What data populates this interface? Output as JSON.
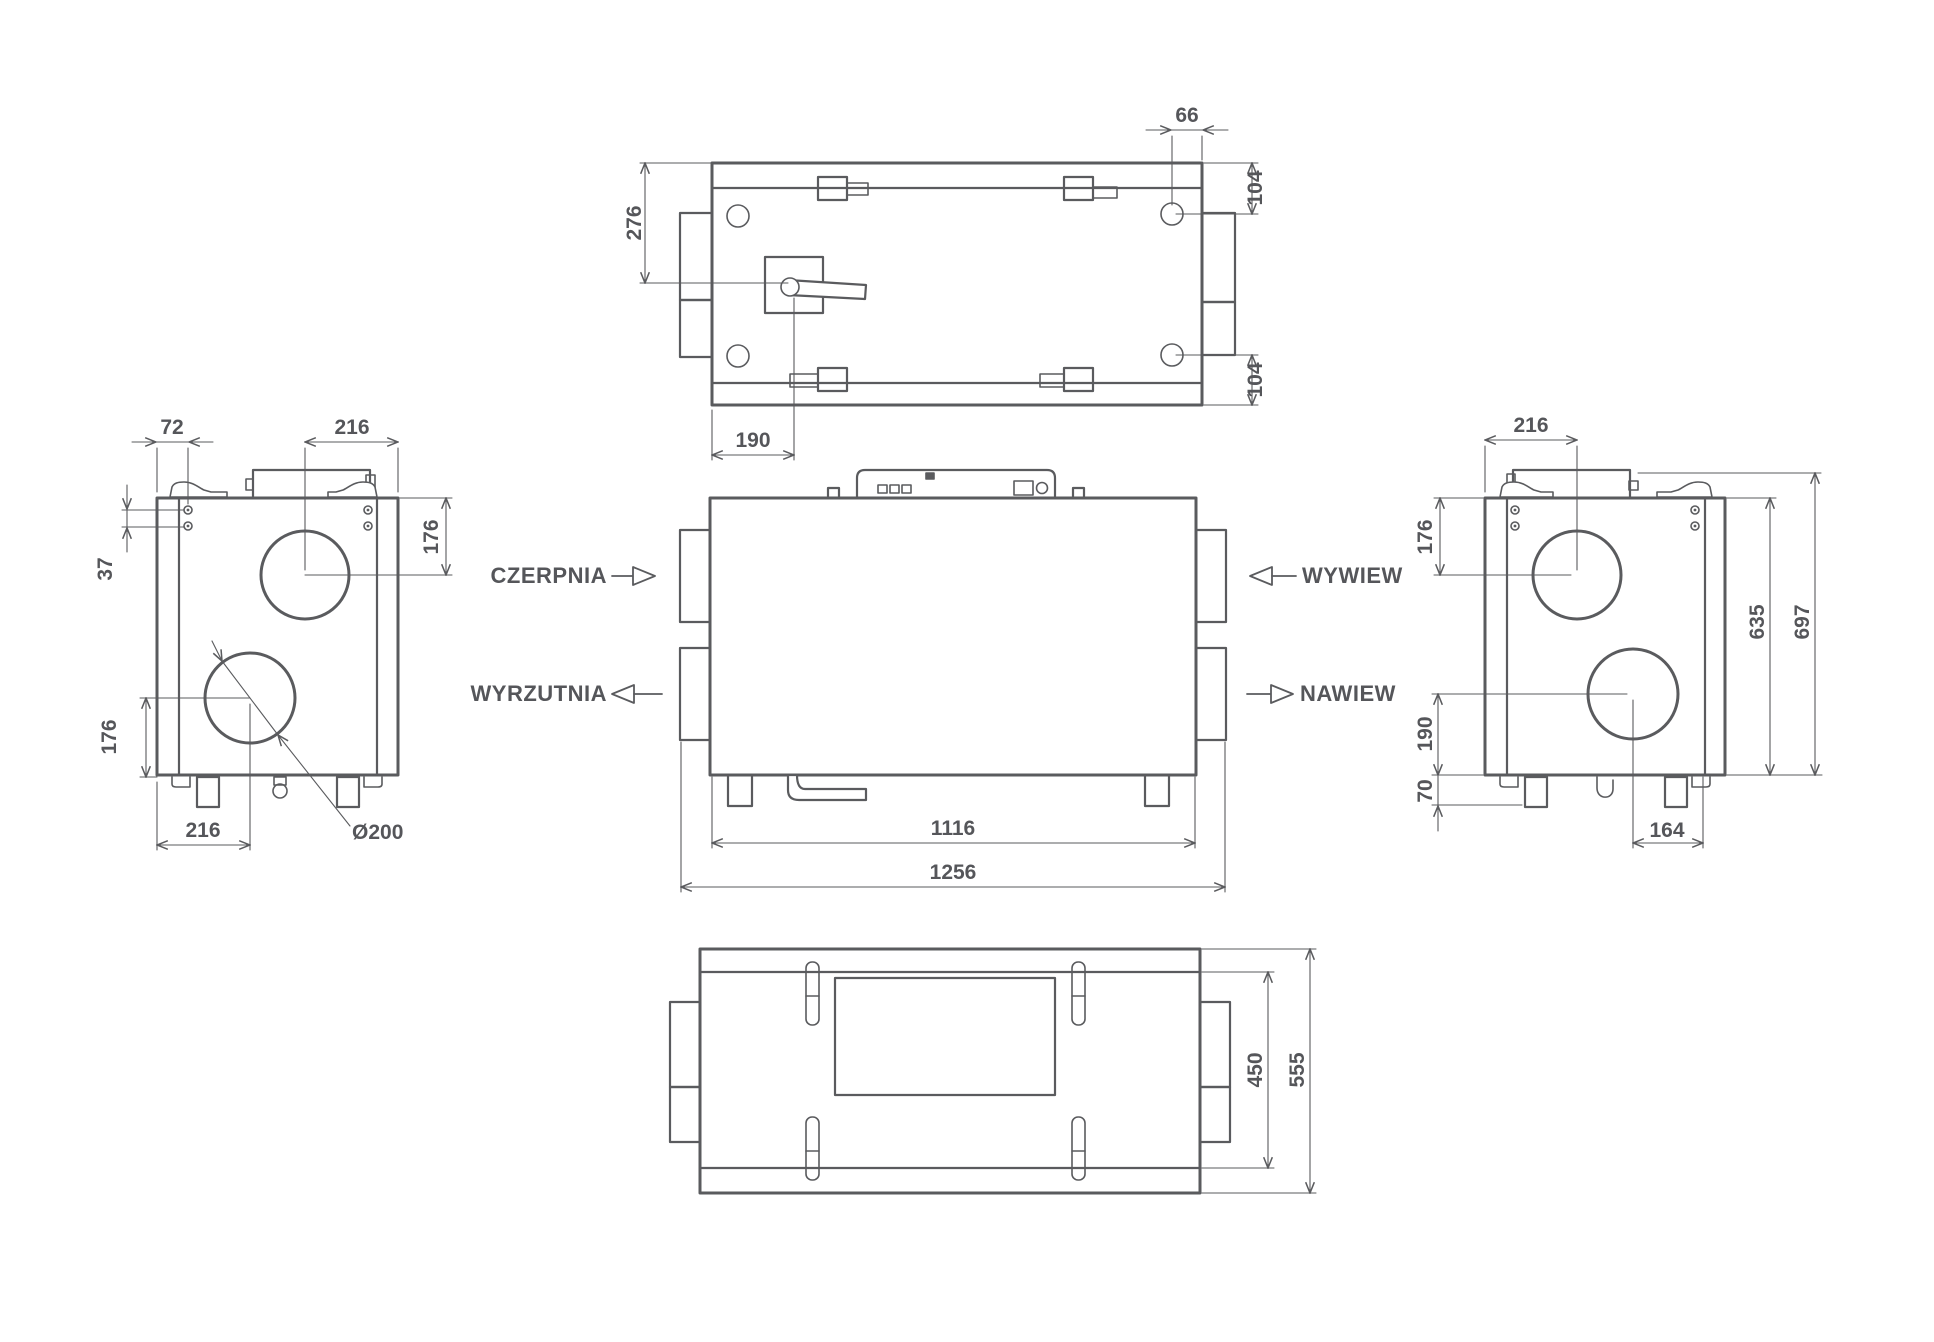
{
  "style": {
    "line_color": "#5a5b5e",
    "text_color": "#55565a",
    "background": "#ffffff"
  },
  "views": {
    "top": {
      "dims": {
        "hole_offset_66": "66",
        "hole_back_104": "104",
        "hole_front_104": "104",
        "handle_depth_276": "276",
        "handle_offset_190": "190"
      }
    },
    "left": {
      "dims": {
        "edge_72": "72",
        "top_port_216": "216",
        "holes_37": "37",
        "top_port_176": "176",
        "bottom_port_176": "176",
        "bottom_port_216": "216",
        "port_diameter": "Ø200"
      }
    },
    "front": {
      "labels": {
        "czerpnia": "CZERPNIA",
        "wyrzutnia": "WYRZUTNIA",
        "wywiew": "WYWIEW",
        "nawiew": "NAWIEW"
      },
      "dims": {
        "body_width_1116": "1116",
        "total_width_1256": "1256"
      }
    },
    "right": {
      "dims": {
        "top_port_216": "216",
        "top_port_176": "176",
        "body_height_635": "635",
        "total_height_697": "697",
        "bottom_port_190": "190",
        "feet_70": "70",
        "bottom_port_164": "164"
      }
    },
    "bottom": {
      "dims": {
        "inner_depth_450": "450",
        "total_depth_555": "555"
      }
    }
  }
}
